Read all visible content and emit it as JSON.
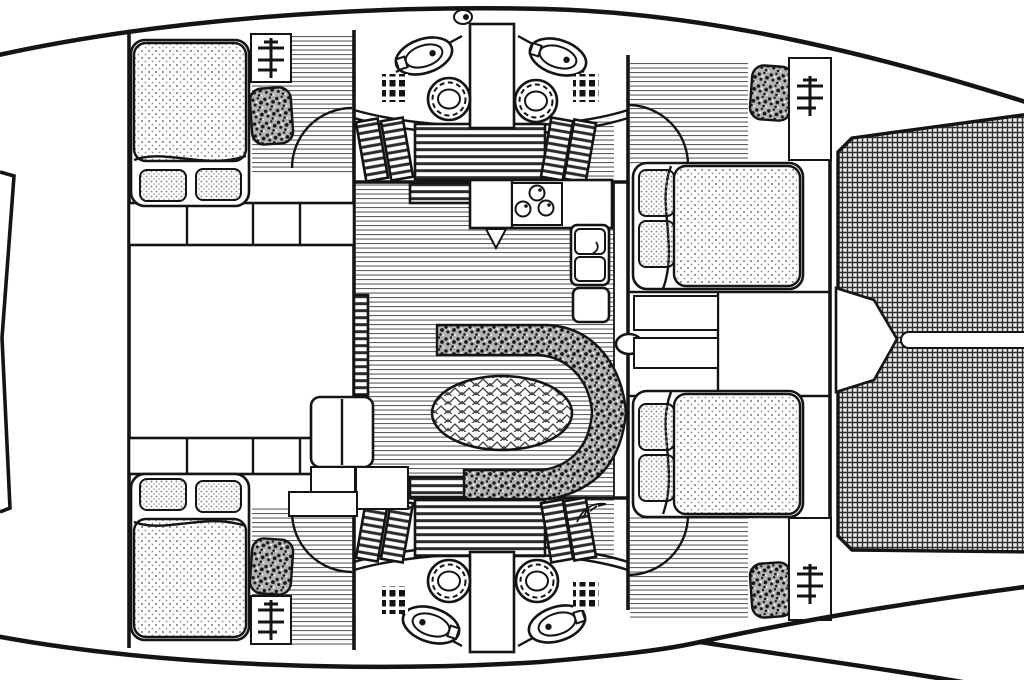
{
  "meta": {
    "title": "Sailing yacht interior deck plan — overhead line drawing",
    "style": "black and white architectural line art",
    "orientation": "bow with trampoline at right, stern at left"
  },
  "canvas": {
    "width": 1024,
    "height": 680,
    "background": "#ffffff"
  },
  "palette": {
    "paper": "#ffffff",
    "ink": "#141414",
    "plank-line": "#5e5e5e",
    "stipple-dot": "#8f8f8f",
    "speckle-base": "#b3b3b3",
    "speckle-ink": "#161616",
    "slat": "#2b2b2b",
    "mesh-base": "#ededed",
    "mesh-line": "#2f2f2f",
    "herring-line": "#3e3e3e"
  },
  "regions": [
    {
      "id": "hull-outline",
      "label": "Hull outline"
    },
    {
      "id": "bow-tip",
      "label": "Pointed stern tip at far left"
    },
    {
      "id": "trampoline",
      "label": "Bow trampoline of woven mesh, right side"
    },
    {
      "id": "anchor-notch",
      "label": "White anchor-well notch in trampoline"
    },
    {
      "id": "trampoline-seam",
      "label": "Central white seam slot in trampoline"
    },
    {
      "id": "cabin-port-aft",
      "label": "Port aft double cabin with berth, pillows, hanging locker"
    },
    {
      "id": "cabin-starboard-aft",
      "label": "Starboard aft double cabin (mirror of port)"
    },
    {
      "id": "cabin-port-forward",
      "label": "Port forward double cabin"
    },
    {
      "id": "cabin-starboard-forward",
      "label": "Starboard forward double cabin"
    },
    {
      "id": "head-port-aft",
      "label": "Port aft head: WC, corner basin, vent grate"
    },
    {
      "id": "head-starboard-aft",
      "label": "Starboard aft head (mirror)"
    },
    {
      "id": "head-port-mirror",
      "label": "Port lower head"
    },
    {
      "id": "head-starboard-mirror",
      "label": "Starboard lower head"
    },
    {
      "id": "companionway-upper",
      "label": "Upper companionway stairs with louvered treads"
    },
    {
      "id": "companionway-lower",
      "label": "Lower companionway stairs (mirror)"
    },
    {
      "id": "galley",
      "label": "Galley: 3-burner stove, twin sinks, lockers"
    },
    {
      "id": "salon",
      "label": "Salon: C-shaped upholstered settee around oval table"
    },
    {
      "id": "nav-station",
      "label": "Chart table with seat"
    },
    {
      "id": "storage-shelves",
      "label": "Shelf/locker bands under port cabins"
    },
    {
      "id": "mid-locker-room",
      "label": "Empty mid-port locker room"
    },
    {
      "id": "forward-lockers",
      "label": "Forward cabinets between bow cabins"
    }
  ],
  "furniture": {
    "double_berths": 4,
    "pillows": 8,
    "heads": 4,
    "toilets": 4,
    "basins": 4,
    "vent_grates": 4,
    "stove_burners": 3,
    "galley_sinks": 2,
    "settee_shape": "C",
    "table_shape": "oval",
    "step_panels": 10,
    "hanging_lockers": 4,
    "door_swing_arcs": 4
  },
  "icons": [
    {
      "name": "mast-step-icon",
      "count": 4
    },
    {
      "name": "deck-cleat-icon",
      "count": 1
    },
    {
      "name": "plant-decor-icon",
      "count": 1
    },
    {
      "name": "door-knob-icon",
      "count": 1
    }
  ],
  "patterns": {
    "berth_mattress": "dot-stipple",
    "upholstery": "dense-dark-speckle",
    "cabin_sole": "horizontal-plank-lines",
    "stairs": "louvered-slats",
    "trampoline": "woven-mesh-grid",
    "tabletop": "herringbone-veneer"
  }
}
